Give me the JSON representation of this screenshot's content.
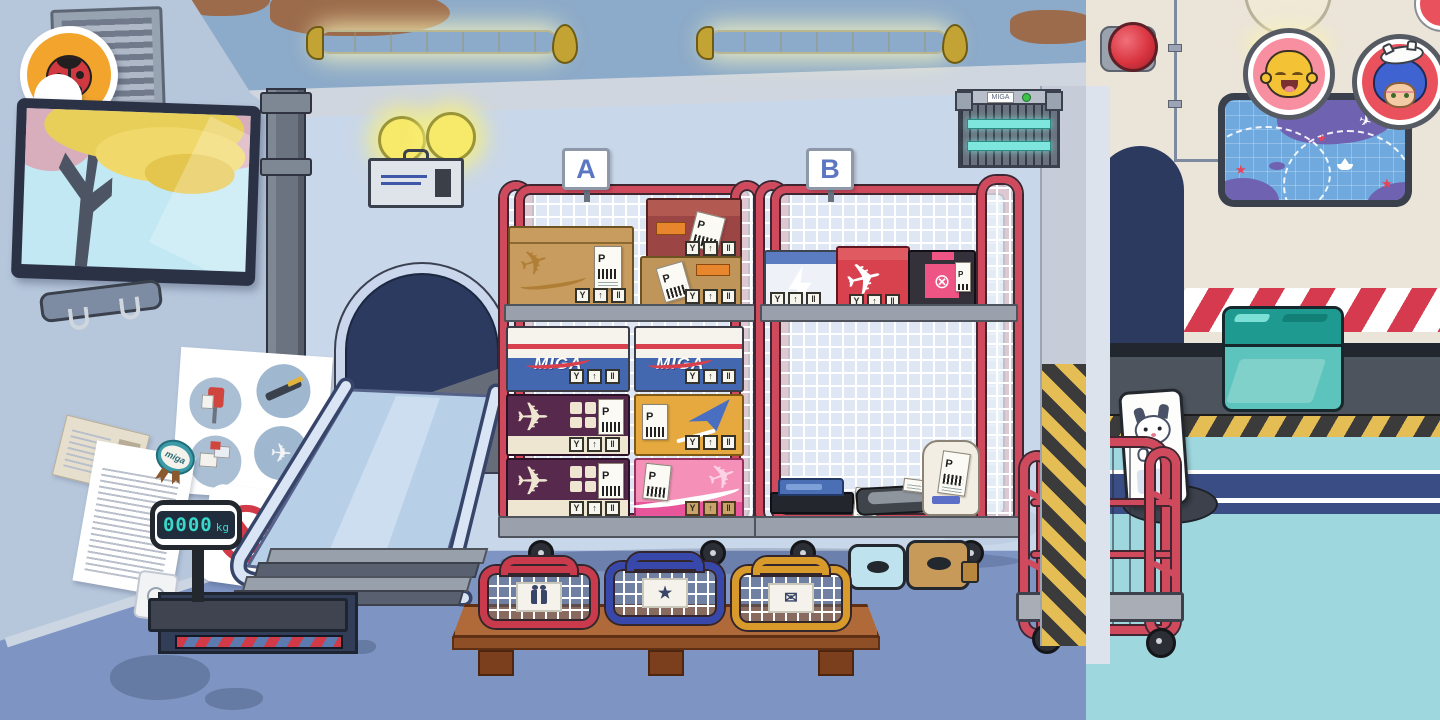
{
  "signs": {
    "cart_a": "A",
    "cart_b": "B",
    "seal_text": "miga"
  },
  "scale": {
    "value": "0000",
    "unit": "kg"
  },
  "brand": {
    "logo": "MIGA"
  },
  "labels": {
    "p": "P"
  },
  "icons": {
    "handling": [
      "Y",
      "↑",
      "‖"
    ],
    "plane": "✈",
    "star": "★",
    "mail": "✉",
    "cancel": "⊗",
    "map_star": "★",
    "map_plane": "✈"
  },
  "hud": {
    "back_button_icon": "ladybug-icon",
    "avatars": [
      {
        "icon": "laughing-kid-avatar",
        "ring_color": "#f78fa0"
      },
      {
        "icon": "cat-hat-kid-avatar",
        "ring_color": "#e9525c"
      }
    ]
  },
  "palette": {
    "cage_red": "#d04a5e",
    "floor_blue": "#7e94c3",
    "floor_teal": "#9fd7df",
    "wall_blue": "#c9d7ea",
    "wall_beige": "#ebe4d9",
    "hazard_red": "#d53a4e",
    "hazard_yellow": "#e5bd55",
    "miga_blue": "#4468b0",
    "scale_digits": "#39d8ca"
  }
}
